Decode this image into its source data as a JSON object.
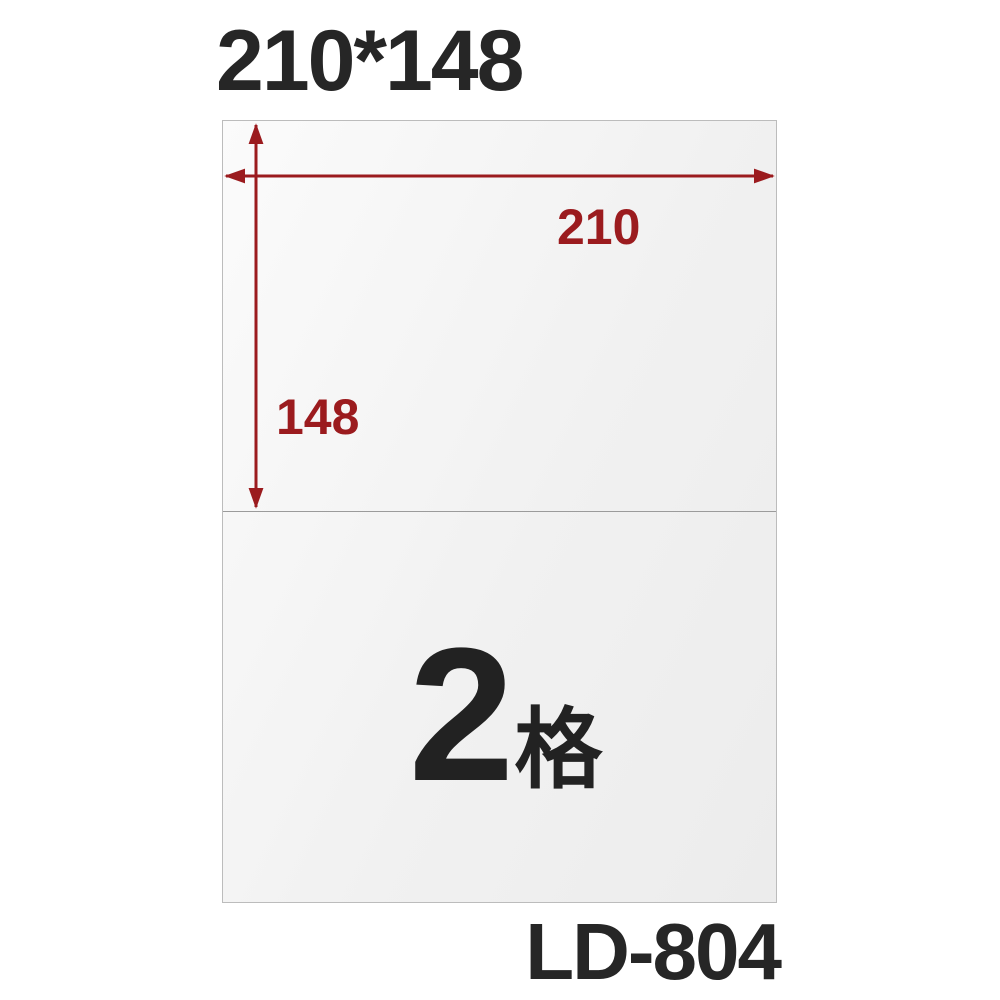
{
  "header": {
    "size_label": "210*148"
  },
  "sheet": {
    "width_label": "210",
    "height_label": "148",
    "cell_count": "2",
    "cell_unit": "格"
  },
  "footer": {
    "model_label": "LD-804"
  },
  "colors": {
    "accent": "#9b1b1e",
    "ink": "#222222",
    "title_ink": "#262626",
    "sheet_border": "#bcbcbc",
    "divider": "#9b9b9b"
  }
}
